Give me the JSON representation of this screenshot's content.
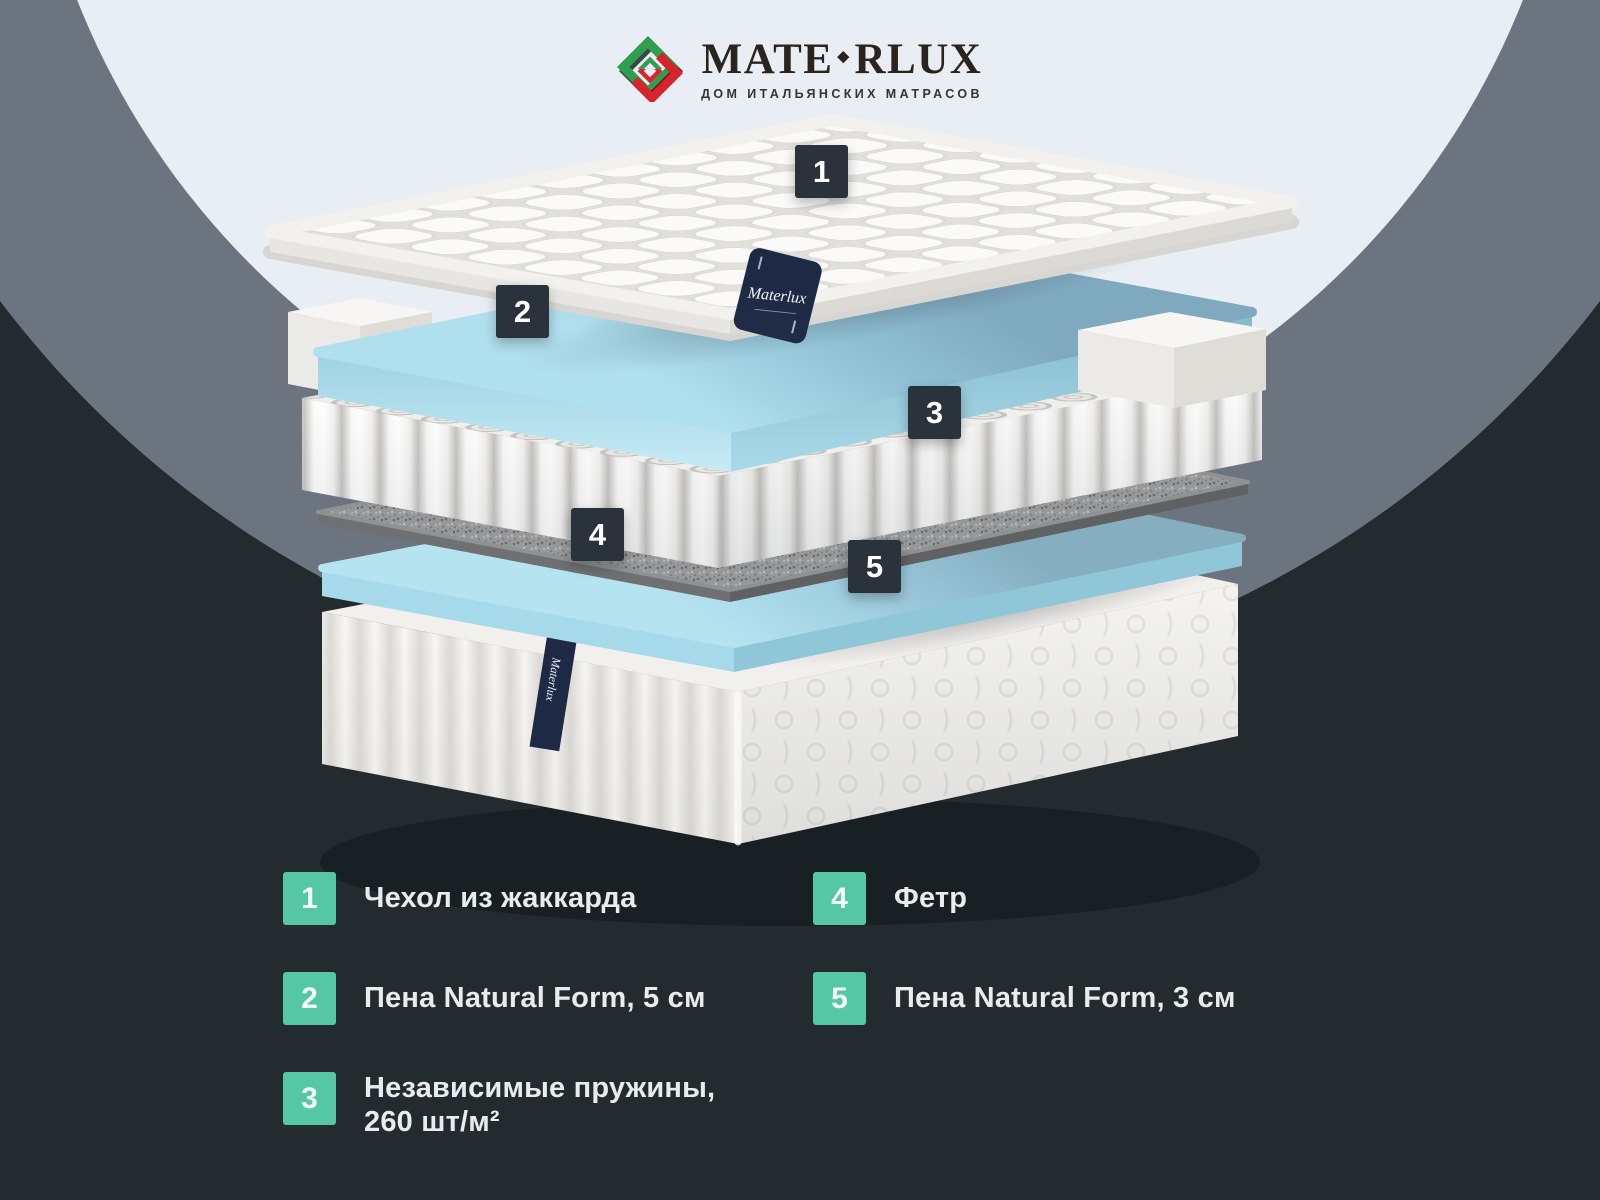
{
  "header": {
    "brand_left": "MATE",
    "brand_diamond": "◆",
    "brand_right": "RLUX",
    "tagline": "ДОМ ИТАЛЬЯНСКИХ МАТРАСОВ"
  },
  "diagram": {
    "markers": [
      {
        "num": "1"
      },
      {
        "num": "2"
      },
      {
        "num": "3"
      },
      {
        "num": "4"
      },
      {
        "num": "5"
      }
    ],
    "tag_label": "Materlux"
  },
  "legend": {
    "items": [
      {
        "num": "1",
        "label": "Чехол из жаккарда",
        "label2": ""
      },
      {
        "num": "2",
        "label": "Пена Natural Form, 5 см",
        "label2": ""
      },
      {
        "num": "3",
        "label": "Независимые пружины,",
        "label2": "260 шт/м²"
      },
      {
        "num": "4",
        "label": "Фетр",
        "label2": ""
      },
      {
        "num": "5",
        "label": "Пена Natural Form, 3 см",
        "label2": ""
      }
    ]
  },
  "colors": {
    "background_dark": "#232b2e",
    "circle_gray": "#6c7480",
    "circle_light": "#e9edf4",
    "accent_teal": "#55c8a3",
    "marker_dark": "#2a323c",
    "foam_blue": "#a6d9e9",
    "tag_navy": "#1d2945",
    "logo_green": "#2f9e4f",
    "logo_red": "#d8232e"
  }
}
